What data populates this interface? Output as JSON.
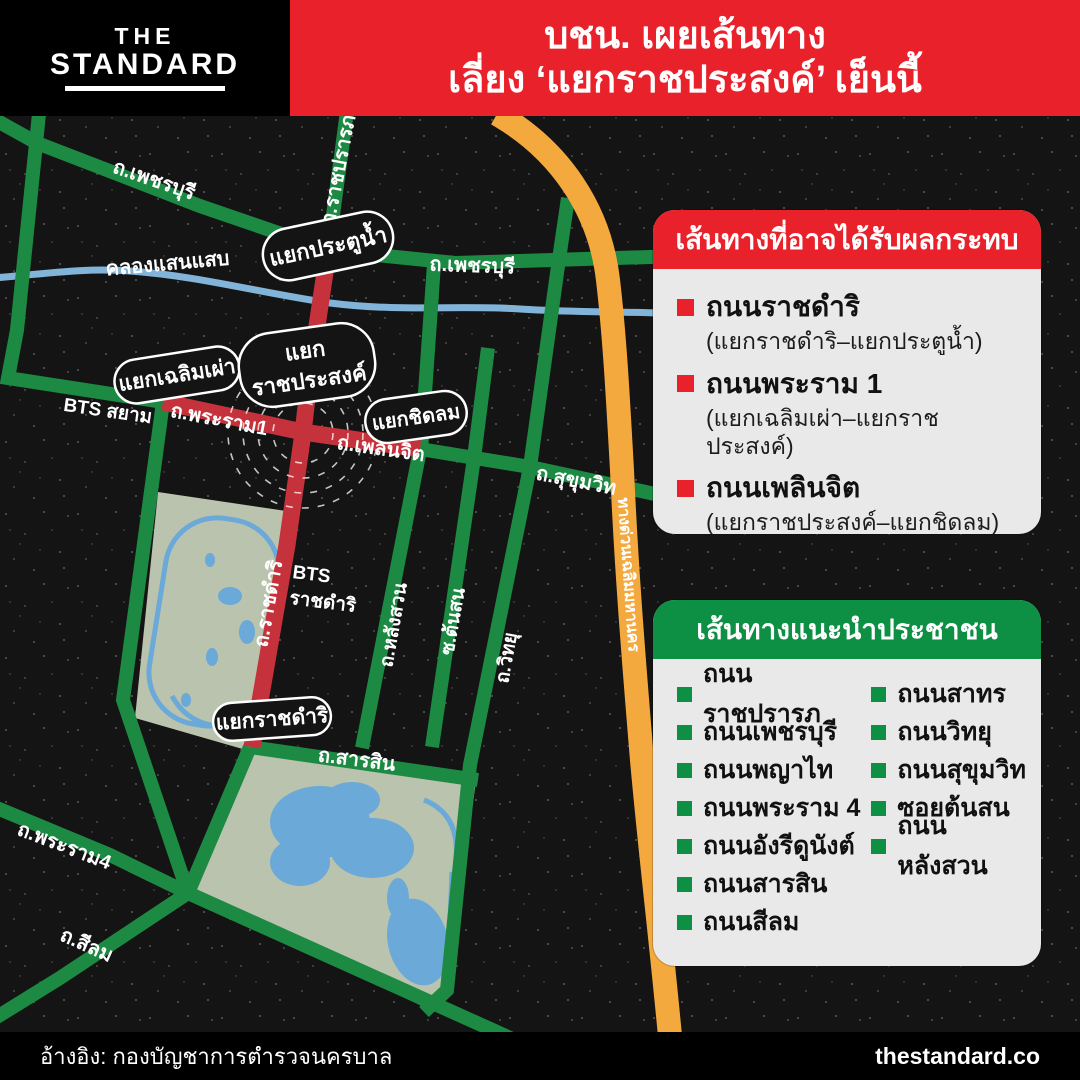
{
  "brand": {
    "logo_line1": "THE",
    "logo_line2": "STANDARD"
  },
  "header": {
    "title_line1": "บชน. เผยเส้นทาง",
    "title_line2": "เลี่ยง ‘แยกราชประสงค์’ เย็นนี้"
  },
  "affected_card": {
    "title": "เส้นทางที่อาจได้รับผลกระทบ",
    "items": [
      {
        "name": "ถนนราชดำริ",
        "detail": "(แยกราชดำริ–แยกประตูน้ำ)"
      },
      {
        "name": "ถนนพระราม 1",
        "detail": "(แยกเฉลิมเผ่า–แยกราชประสงค์)"
      },
      {
        "name": "ถนนเพลินจิต",
        "detail": "(แยกราชประสงค์–แยกชิดลม)"
      }
    ]
  },
  "recommended_card": {
    "title": "เส้นทางแนะนำประชาชน",
    "column1": [
      "ถนนราชปรารภ",
      "ถนนเพชรบุรี",
      "ถนนพญาไท",
      "ถนนพระราม 4",
      "ถนนอังรีดูนังต์",
      "ถนนสารสิน",
      "ถนนสีลม"
    ],
    "column2": [
      "ถนนสาทร",
      "ถนนวิทยุ",
      "ถนนสุขุมวิท",
      "ซอยต้นสน",
      "ถนนหลังสวน"
    ]
  },
  "footer": {
    "source": "อ้างอิง: กองบัญชาการตำรวจนครบาล",
    "site": "thestandard.co"
  },
  "map": {
    "colors": {
      "background": "#141414",
      "accent_red": "#e8212b",
      "accent_green": "#0d8f44",
      "road_green": "#1d8a43",
      "road_red": "#c5323b",
      "expressway_orange": "#f4a93f",
      "expressway_label": "#3e2d07",
      "canal_blue": "#82b4da",
      "park_green": "#bac3ad",
      "lake_blue": "#6aa9d8"
    },
    "labels": {
      "phetchaburi_nw": "ถ.เพชรบุรี",
      "ratchaprarop": "ถ.ราชปรารภ",
      "khlong_saen_saep": "คลองแสนแสบ",
      "phetchaburi_e": "ถ.เพชรบุรี",
      "rama1": "ถ.พระราม1",
      "phloenchit": "ถ.เพลินจิต",
      "sukhumvit": "ถ.สุขุมวิท",
      "ratchadamri_road": "ถ.ราชดำริ",
      "langsuan": "ถ.หลังสวน",
      "tonson": "ซ.ต้นสน",
      "witthayu": "ถ.วิทยุ",
      "expressway": "ทางด่วนเฉลิมมหานคร",
      "sarasin": "ถ.สารสิน",
      "rama4": "ถ.พระราม4",
      "silom": "ถ.สีลม",
      "bts_siam": "BTS สยาม",
      "bts_ratchadamri_1": "BTS",
      "bts_ratchadamri_2": "ราชดำริ"
    },
    "junctions": {
      "pratunam": "แยกประตูน้ำ",
      "chaloem_phao": "แยกเฉลิมเผ่า",
      "ratchaprasong_1": "แยก",
      "ratchaprasong_2": "ราชประสงค์",
      "chidlom": "แยกชิดลม",
      "ratchadamri": "แยกราชดำริ"
    }
  }
}
